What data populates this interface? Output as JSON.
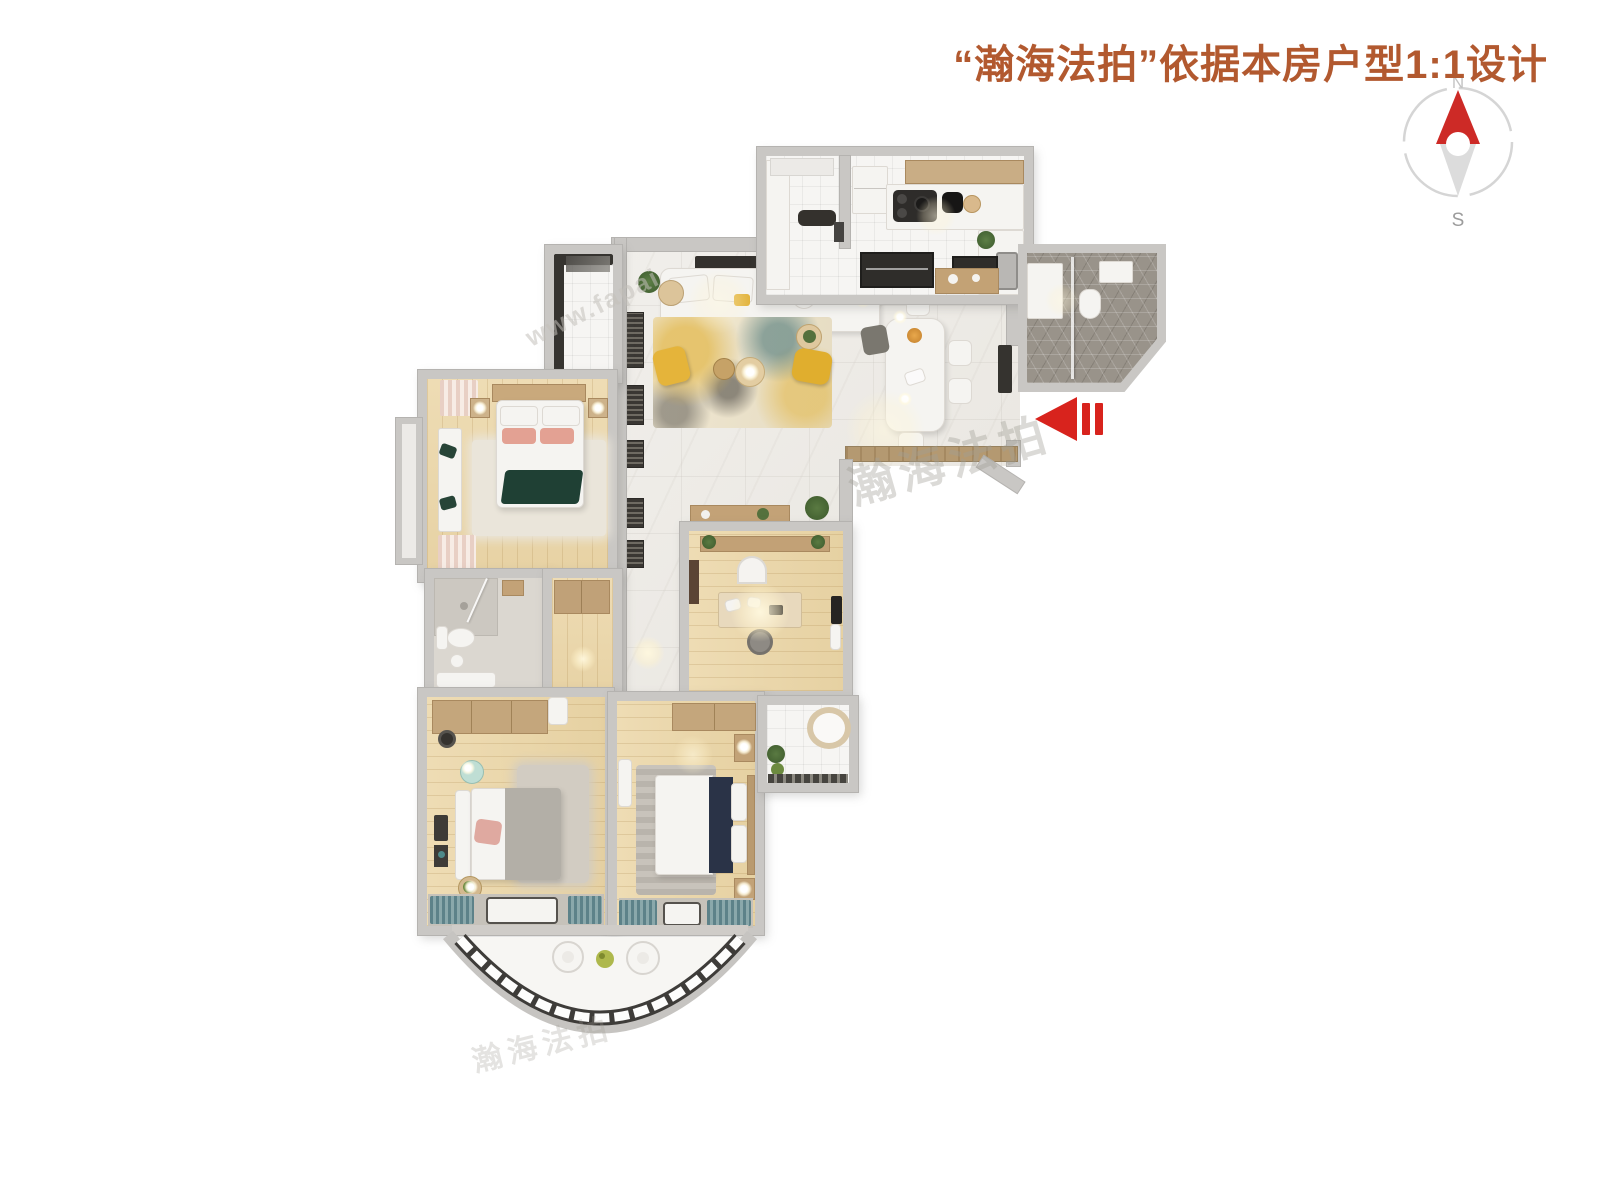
{
  "header": {
    "title": "“瀚海法拍”依据本房户型1:1设计"
  },
  "compass": {
    "north_label": "N",
    "south_label": "S"
  },
  "entrance_arrow": {
    "direction": "left",
    "color": "#d8231d"
  },
  "watermarks": {
    "brand_cn_1": "瀚海法拍",
    "brand_cn_2": "瀚海法拍",
    "brand_url": "www.fapai"
  },
  "palette": {
    "title_text": "#b2592f",
    "arrow_red": "#d8231d",
    "compass_north_red": "#cd2a26",
    "compass_south_gray": "#dcdcdc",
    "wall_gray": "#c9c7c4",
    "marble_floor": "#edeae5",
    "wood_floor": "#ecd9b0",
    "bath_hex_floor": "#99938a",
    "accent_yellow": "#e2b33c",
    "curtain_teal": "#6f989c",
    "throw_green": "#1f4034",
    "navy_blanket": "#2a3347"
  }
}
